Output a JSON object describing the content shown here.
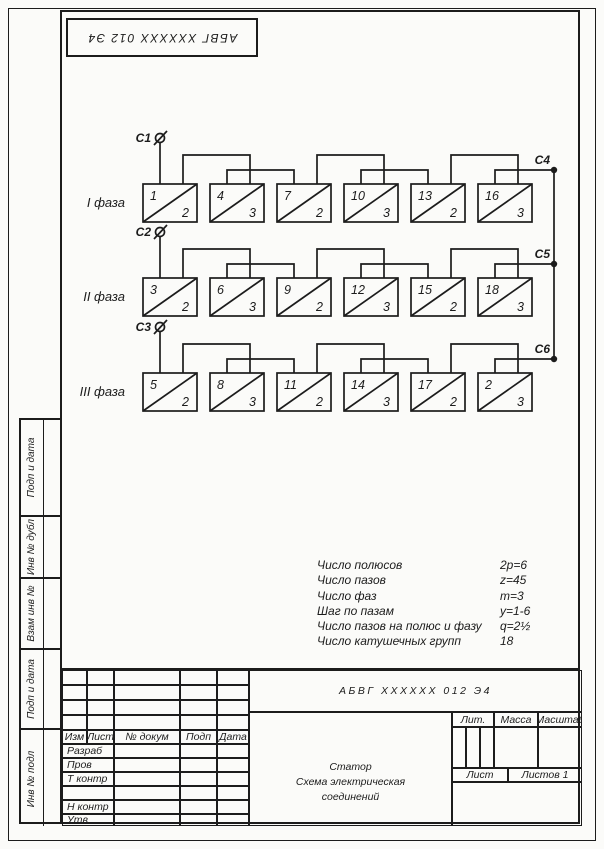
{
  "stamp": {
    "designation": "АБВГ ХХХХХХ 012 Э4"
  },
  "schematic": {
    "phases": [
      {
        "label": "I фаза",
        "terminal_in": "C1",
        "groups": [
          {
            "num": "1",
            "coils": "2"
          },
          {
            "num": "4",
            "coils": "3"
          },
          {
            "num": "7",
            "coils": "2"
          },
          {
            "num": "10",
            "coils": "3"
          },
          {
            "num": "13",
            "coils": "2"
          },
          {
            "num": "16",
            "coils": "3"
          }
        ]
      },
      {
        "label": "II фаза",
        "terminal_in": "C2",
        "groups": [
          {
            "num": "3",
            "coils": "2"
          },
          {
            "num": "6",
            "coils": "3"
          },
          {
            "num": "9",
            "coils": "2"
          },
          {
            "num": "12",
            "coils": "3"
          },
          {
            "num": "15",
            "coils": "2"
          },
          {
            "num": "18",
            "coils": "3"
          }
        ]
      },
      {
        "label": "III фаза",
        "terminal_in": "C3",
        "groups": [
          {
            "num": "5",
            "coils": "2"
          },
          {
            "num": "8",
            "coils": "3"
          },
          {
            "num": "11",
            "coils": "2"
          },
          {
            "num": "14",
            "coils": "3"
          },
          {
            "num": "17",
            "coils": "2"
          },
          {
            "num": "2",
            "coils": "3"
          }
        ]
      }
    ],
    "star_terminals": [
      "C4",
      "C5",
      "C6"
    ]
  },
  "parameters": {
    "rows": [
      {
        "name": "Число полюсов",
        "value": "2p=6"
      },
      {
        "name": "Число пазов",
        "value": "z=45"
      },
      {
        "name": "Число фаз",
        "value": "m=3"
      },
      {
        "name": "Шаг по пазам",
        "value": "y=1-6"
      },
      {
        "name": "Число пазов на полюс и фазу",
        "value": "q=2½"
      },
      {
        "name": "Число катушечных групп",
        "value": "18"
      }
    ]
  },
  "margin_strip": {
    "labels": [
      "Подп и дата",
      "Инв № дубл",
      "Взам инв №",
      "Подп и дата",
      "Инв № подл"
    ]
  },
  "title_block": {
    "designation": "АБВГ ХХХХХХ 012 Э4",
    "name_lines": [
      "Статор",
      "Схема электрическая",
      "соединений"
    ],
    "header_cols": [
      "Изм",
      "Лист",
      "№ докум",
      "Подп",
      "Дата"
    ],
    "role_rows": [
      "Разраб",
      "Пров",
      "Т контр",
      "",
      "Н контр",
      "Утв"
    ],
    "lit_label": "Лит.",
    "massa_label": "Масса",
    "masshtab_label": "Масштаб",
    "list_label": "Лист",
    "listov_label": "Листов 1"
  },
  "colors": {
    "ink": "#1c1c1c",
    "paper": "#fbfbf9"
  }
}
